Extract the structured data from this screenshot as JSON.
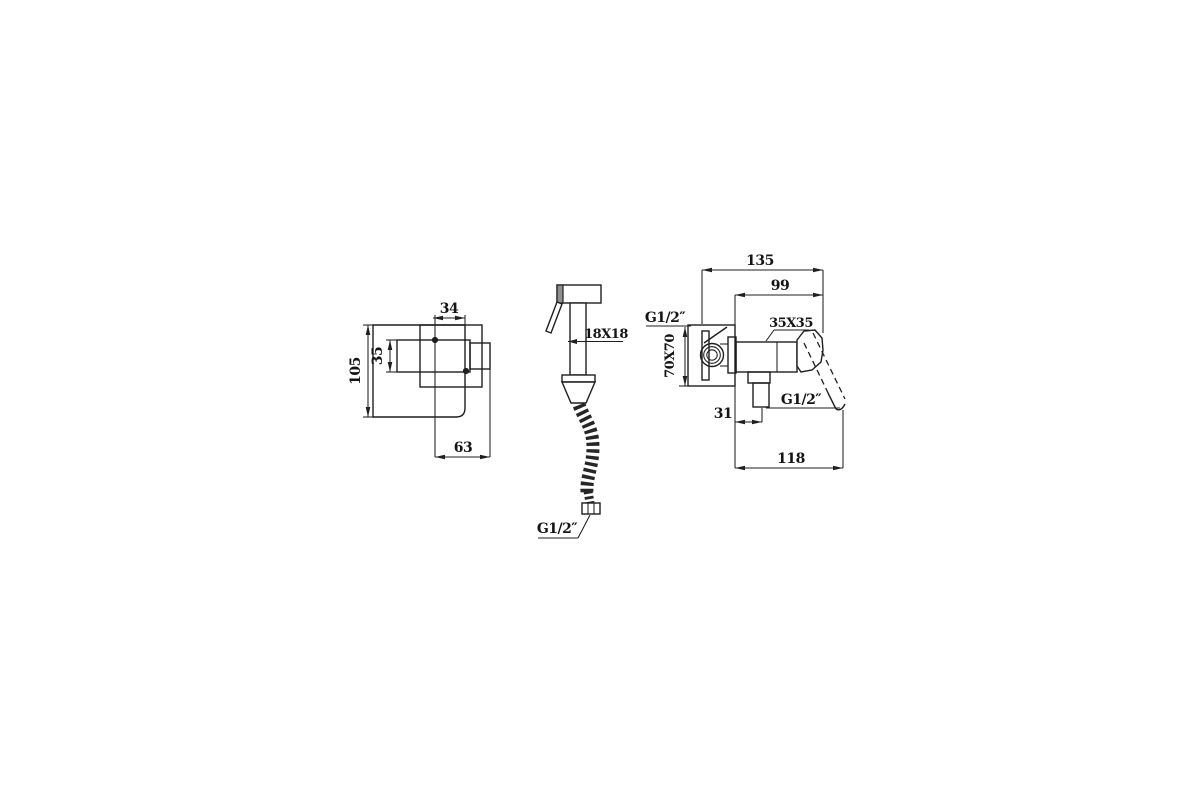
{
  "drawing": {
    "type": "technical-drawing",
    "subject": "concealed bidet mixer with hand spray - dimensional drawing",
    "line_color": "#1f1f1f",
    "background_color": "#ffffff",
    "front_view": {
      "plate_height": "105",
      "handle_width": "34",
      "handle_height": "35",
      "handle_reach": "63"
    },
    "sprayer_view": {
      "body_section": "18X18",
      "hose_thread": "G1/2″"
    },
    "side_view": {
      "total_depth": "135",
      "body_depth": "99",
      "inlet_thread": "G1/2″",
      "plate_size": "70X70",
      "body_size": "35X35",
      "outlet_thread": "G1/2″",
      "outlet_offset": "31",
      "handle_reach": "118"
    }
  }
}
